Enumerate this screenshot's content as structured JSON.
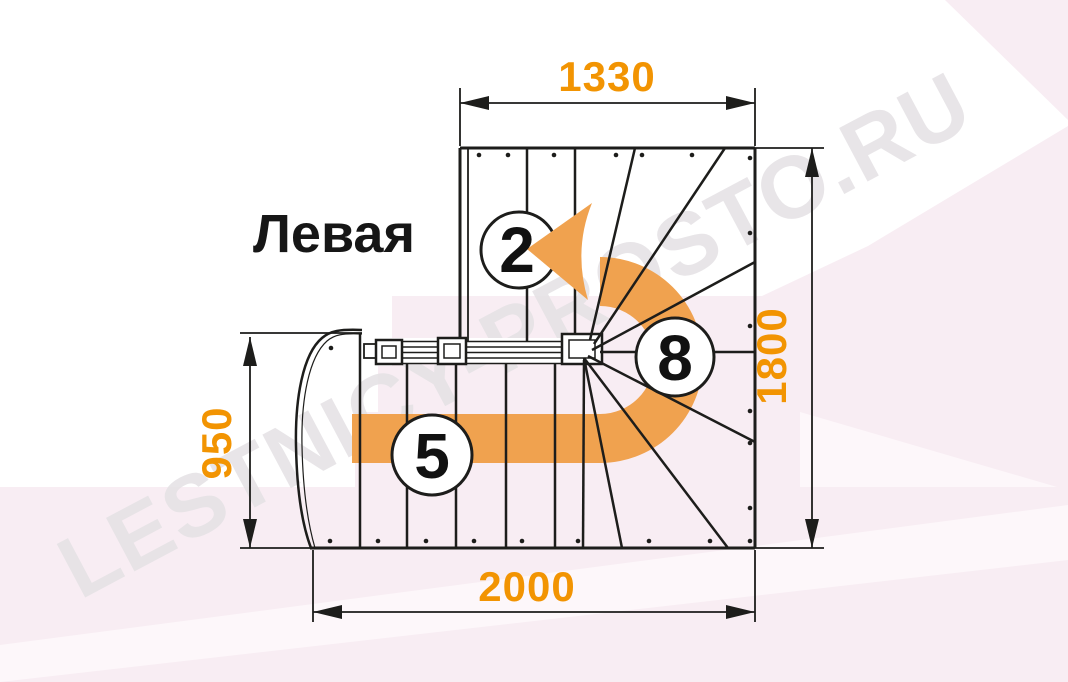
{
  "title": "Левая",
  "watermark": "LESTNICY-PROSTO.RU",
  "dimensions": {
    "top": "1330",
    "right": "1800",
    "left": "950",
    "bottom": "2000"
  },
  "steps": {
    "upper_flight_count": "2",
    "lower_flight_count": "5",
    "winder_count": "8"
  },
  "colors": {
    "accent": "#f29402",
    "arrow": "#f0a24f",
    "ink": "#1d1d1b",
    "pink": "#f8edf3",
    "pinkLight": "#fdf7fa",
    "watermark": "#e5e2e5",
    "circleFill": "#ffffff"
  }
}
